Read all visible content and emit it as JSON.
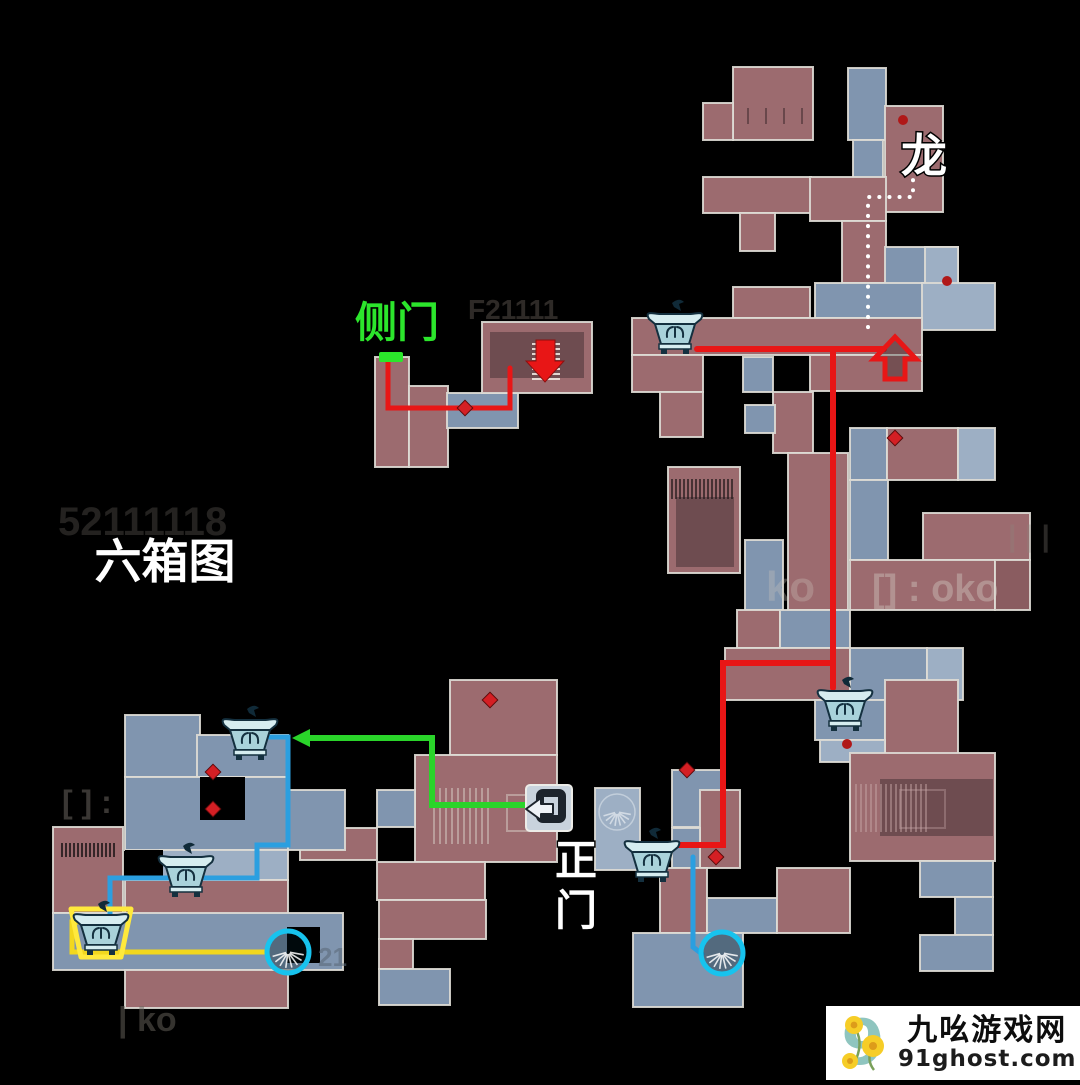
{
  "page": {
    "title": "六箱图"
  },
  "map": {
    "background": "#000000",
    "palette": {
      "room_red": "#9c6b6f",
      "room_red_dark": "#8a5c60",
      "room_inner_dark": "#6e4c50",
      "room_blue": "#8095af",
      "room_blue_light": "#9dafc4",
      "wall": "#dedbd5",
      "route_red": "#e81616",
      "route_green": "#2ad42a",
      "route_blue": "#2b9fe0",
      "route_yellow": "#f2d71e",
      "circle_cyan": "#17c3ee",
      "marker_red": "#d41f24",
      "door_green": "#2be62b",
      "dotted_white": "#ffffff"
    },
    "rooms": [
      [
        733,
        67,
        80,
        73,
        "r"
      ],
      [
        703,
        103,
        30,
        37,
        "r"
      ],
      [
        848,
        68,
        38,
        72,
        "b"
      ],
      [
        853,
        140,
        30,
        38,
        "b"
      ],
      [
        885,
        106,
        58,
        106,
        "r"
      ],
      [
        703,
        177,
        108,
        36,
        "r"
      ],
      [
        740,
        213,
        35,
        38,
        "r"
      ],
      [
        810,
        177,
        76,
        44,
        "r"
      ],
      [
        842,
        221,
        44,
        62,
        "r"
      ],
      [
        885,
        247,
        73,
        42,
        "b"
      ],
      [
        925,
        247,
        33,
        42,
        "b2"
      ],
      [
        815,
        283,
        108,
        35,
        "b"
      ],
      [
        922,
        283,
        73,
        47,
        "b2"
      ],
      [
        733,
        287,
        77,
        31,
        "r"
      ],
      [
        632,
        318,
        290,
        37,
        "r"
      ],
      [
        810,
        355,
        112,
        36,
        "r"
      ],
      [
        632,
        355,
        71,
        37,
        "r"
      ],
      [
        660,
        392,
        43,
        45,
        "r"
      ],
      [
        743,
        357,
        30,
        35,
        "b"
      ],
      [
        773,
        392,
        40,
        61,
        "r"
      ],
      [
        668,
        467,
        72,
        106,
        "r"
      ],
      [
        676,
        497,
        58,
        70,
        "d"
      ],
      [
        745,
        405,
        30,
        28,
        "b"
      ],
      [
        745,
        540,
        38,
        70,
        "b"
      ],
      [
        788,
        453,
        60,
        157,
        "r"
      ],
      [
        850,
        428,
        37,
        52,
        "b"
      ],
      [
        887,
        428,
        71,
        52,
        "r"
      ],
      [
        958,
        428,
        37,
        52,
        "b2"
      ],
      [
        850,
        480,
        38,
        80,
        "b"
      ],
      [
        923,
        513,
        107,
        47,
        "r"
      ],
      [
        850,
        560,
        145,
        50,
        "r"
      ],
      [
        995,
        560,
        35,
        50,
        "r2"
      ],
      [
        737,
        610,
        43,
        38,
        "r"
      ],
      [
        780,
        610,
        70,
        38,
        "b"
      ],
      [
        725,
        648,
        125,
        52,
        "r"
      ],
      [
        850,
        648,
        77,
        52,
        "b"
      ],
      [
        927,
        648,
        36,
        52,
        "b2"
      ],
      [
        815,
        700,
        70,
        40,
        "b"
      ],
      [
        885,
        680,
        73,
        80,
        "r"
      ],
      [
        820,
        740,
        65,
        22,
        "b2"
      ],
      [
        672,
        770,
        50,
        57,
        "b"
      ],
      [
        850,
        753,
        145,
        108,
        "r"
      ],
      [
        880,
        779,
        113,
        57,
        "d"
      ],
      [
        920,
        861,
        73,
        36,
        "b"
      ],
      [
        955,
        897,
        38,
        38,
        "b"
      ],
      [
        920,
        935,
        73,
        36,
        "b"
      ],
      [
        700,
        790,
        40,
        78,
        "r"
      ],
      [
        672,
        828,
        28,
        40,
        "b"
      ],
      [
        660,
        868,
        47,
        65,
        "r"
      ],
      [
        707,
        898,
        70,
        35,
        "b"
      ],
      [
        777,
        868,
        73,
        65,
        "r"
      ],
      [
        633,
        933,
        110,
        74,
        "b"
      ],
      [
        450,
        680,
        107,
        75,
        "r"
      ],
      [
        415,
        755,
        142,
        107,
        "r"
      ],
      [
        377,
        790,
        38,
        37,
        "b"
      ],
      [
        300,
        828,
        77,
        32,
        "r"
      ],
      [
        377,
        862,
        108,
        38,
        "r"
      ],
      [
        379,
        900,
        107,
        39,
        "r"
      ],
      [
        379,
        939,
        34,
        30,
        "r"
      ],
      [
        379,
        969,
        71,
        36,
        "b"
      ],
      [
        595,
        788,
        45,
        82,
        "b2"
      ],
      [
        125,
        715,
        75,
        62,
        "b"
      ],
      [
        197,
        735,
        91,
        42,
        "b"
      ],
      [
        125,
        777,
        163,
        73,
        "b"
      ],
      [
        288,
        790,
        57,
        60,
        "b"
      ],
      [
        160,
        850,
        128,
        30,
        "b2"
      ],
      [
        53,
        827,
        70,
        86,
        "r"
      ],
      [
        125,
        880,
        163,
        35,
        "r"
      ],
      [
        53,
        913,
        290,
        57,
        "b"
      ],
      [
        287,
        927,
        33,
        36,
        "k"
      ],
      [
        125,
        970,
        163,
        38,
        "r"
      ],
      [
        200,
        777,
        45,
        43,
        "k"
      ],
      [
        125,
        850,
        38,
        30,
        "k"
      ],
      [
        375,
        357,
        34,
        110,
        "r"
      ],
      [
        409,
        386,
        39,
        81,
        "r"
      ],
      [
        447,
        393,
        71,
        35,
        "b"
      ],
      [
        482,
        322,
        110,
        71,
        "r"
      ],
      [
        490,
        332,
        94,
        46,
        "d"
      ]
    ],
    "textures": [
      {
        "t": "v",
        "x": 434,
        "y": 788,
        "w": 58,
        "h": 56,
        "g": 6,
        "c": "#d8cfc8",
        "o": 0.5
      },
      {
        "t": "r",
        "x": 507,
        "y": 795,
        "w": 33,
        "h": 36,
        "c": "#d8cfc8",
        "o": 0.5
      },
      {
        "t": "h",
        "x": 532,
        "y": 344,
        "w": 28,
        "h": 36,
        "g": 5,
        "c": "#efe7e0",
        "o": 0.9
      },
      {
        "t": "v",
        "x": 856,
        "y": 784,
        "w": 72,
        "h": 48,
        "g": 5,
        "c": "#c9a9a9",
        "o": 0.45
      },
      {
        "t": "r",
        "x": 900,
        "y": 790,
        "w": 45,
        "h": 38,
        "c": "#c9a9a9",
        "o": 0.35
      },
      {
        "t": "v",
        "x": 62,
        "y": 843,
        "w": 52,
        "h": 14,
        "g": 4,
        "c": "#241a1c",
        "o": 0.85
      },
      {
        "t": "v",
        "x": 672,
        "y": 479,
        "w": 62,
        "h": 20,
        "g": 4,
        "c": "#241a1c",
        "o": 0.7
      },
      {
        "t": "v",
        "x": 748,
        "y": 108,
        "w": 54,
        "h": 16,
        "g": 18,
        "c": "#5d3f43",
        "o": 0.8
      }
    ],
    "routes": [
      {
        "name": "route-sidedoor-red",
        "c": "route_red",
        "w": 5,
        "d": "M388,362 L388,408 L510,408 L510,368"
      },
      {
        "name": "route-main-red-horizontal",
        "c": "route_red",
        "w": 6,
        "d": "M697,349 L884,349"
      },
      {
        "name": "route-main-red-vertical",
        "c": "route_red",
        "w": 6,
        "d": "M833,349 L833,688"
      },
      {
        "name": "route-main-red-branch",
        "c": "route_red",
        "w": 6,
        "d": "M833,663 L723,663 L723,845 L672,845"
      },
      {
        "name": "route-green",
        "c": "route_green",
        "w": 6,
        "d": "M310,738 L432,738 L432,805 L534,805"
      },
      {
        "name": "route-blue-left",
        "c": "route_blue",
        "w": 5,
        "d": "M262,737 L288,737 L288,845 L257,845 L257,878 L110,878 L110,916"
      },
      {
        "name": "route-blue-right",
        "c": "route_blue",
        "w": 5,
        "d": "M693,857 L693,947 L702,954"
      },
      {
        "name": "route-yellow",
        "c": "route_yellow",
        "w": 5,
        "d": "M88,922 L72,922 L72,952 L266,952"
      },
      {
        "name": "route-dragon-dotted",
        "c": "dotted_white",
        "w": 4,
        "d": "M913,170 L913,197 L868,197 L868,333",
        "dash": "0.1 10"
      }
    ],
    "green_arrowhead": "310,729 292,738 310,747",
    "arrows": {
      "down_filled": "536,340 555,340 555,361 564,361 545,382 526,361 536,361",
      "up_outline": "895,337 916,359 905,359 905,379 885,379 885,359 874,359"
    },
    "door_marker": {
      "x": 379,
      "y": 352,
      "w": 24,
      "h": 10
    },
    "markers": {
      "diamonds": [
        [
          465,
          408
        ],
        [
          213,
          772
        ],
        [
          213,
          809
        ],
        [
          490,
          700
        ],
        [
          687,
          770
        ],
        [
          716,
          857
        ],
        [
          895,
          438
        ]
      ],
      "dots": [
        [
          903,
          120
        ],
        [
          947,
          281
        ],
        [
          847,
          744
        ]
      ],
      "stair_circles": [
        [
          288,
          952
        ],
        [
          722,
          953
        ]
      ],
      "plain_fans": [
        [
          617,
          812
        ]
      ]
    },
    "chests": [
      {
        "x": 675,
        "y": 330,
        "highlight": false
      },
      {
        "x": 845,
        "y": 707,
        "highlight": false
      },
      {
        "x": 250,
        "y": 736,
        "highlight": false
      },
      {
        "x": 186,
        "y": 873,
        "highlight": false
      },
      {
        "x": 101,
        "y": 931,
        "highlight": true
      },
      {
        "x": 652,
        "y": 858,
        "highlight": false
      }
    ],
    "gate_icon": {
      "x": 549,
      "y": 808
    },
    "labels": [
      {
        "id": "label-dragon",
        "text": "龙",
        "x": 924,
        "y": 172,
        "s": 46,
        "c": "#ffffff"
      },
      {
        "id": "label-side-door",
        "text": "侧门",
        "x": 397,
        "y": 337,
        "s": 42,
        "c": "#2ce62c"
      },
      {
        "id": "label-six-box-map",
        "text": "六箱图",
        "x": 165,
        "y": 578,
        "s": 47,
        "c": "#ffffff"
      },
      {
        "id": "label-main-gate-1",
        "text": "正",
        "x": 576,
        "y": 875,
        "s": 42,
        "c": "#ffffff"
      },
      {
        "id": "label-main-gate-2",
        "text": "门",
        "x": 576,
        "y": 925,
        "s": 42,
        "c": "#ffffff"
      }
    ],
    "ghost_texts": [
      {
        "text": "52111118",
        "x": 58,
        "y": 535,
        "s": 40,
        "c": "#a39c93",
        "o": 0.22
      },
      {
        "text": "ko",
        "x": 766,
        "y": 601,
        "s": 42,
        "c": "#cfc8bf",
        "o": 0.3
      },
      {
        "text": "[] : oko",
        "x": 872,
        "y": 601,
        "s": 38,
        "c": "#d8d2c9",
        "o": 0.38
      },
      {
        "text": "[ ] :",
        "x": 62,
        "y": 813,
        "s": 32,
        "c": "#756f68",
        "o": 0.5
      },
      {
        "text": "| ko",
        "x": 118,
        "y": 1031,
        "s": 34,
        "c": "#6b665f",
        "o": 0.5
      },
      {
        "text": "F21111",
        "x": 468,
        "y": 319,
        "s": 28,
        "c": "#978c80",
        "o": 0.3
      },
      {
        "text": "| | |",
        "x": 1008,
        "y": 546,
        "s": 30,
        "c": "#8d867d",
        "o": 0.3
      },
      {
        "text": "21",
        "x": 318,
        "y": 966,
        "s": 26,
        "c": "#5d6b7a",
        "o": 0.6
      }
    ]
  },
  "watermark": {
    "site_name": "九吆游戏网",
    "site_url": "91ghost.com",
    "logo_digit": "9"
  }
}
